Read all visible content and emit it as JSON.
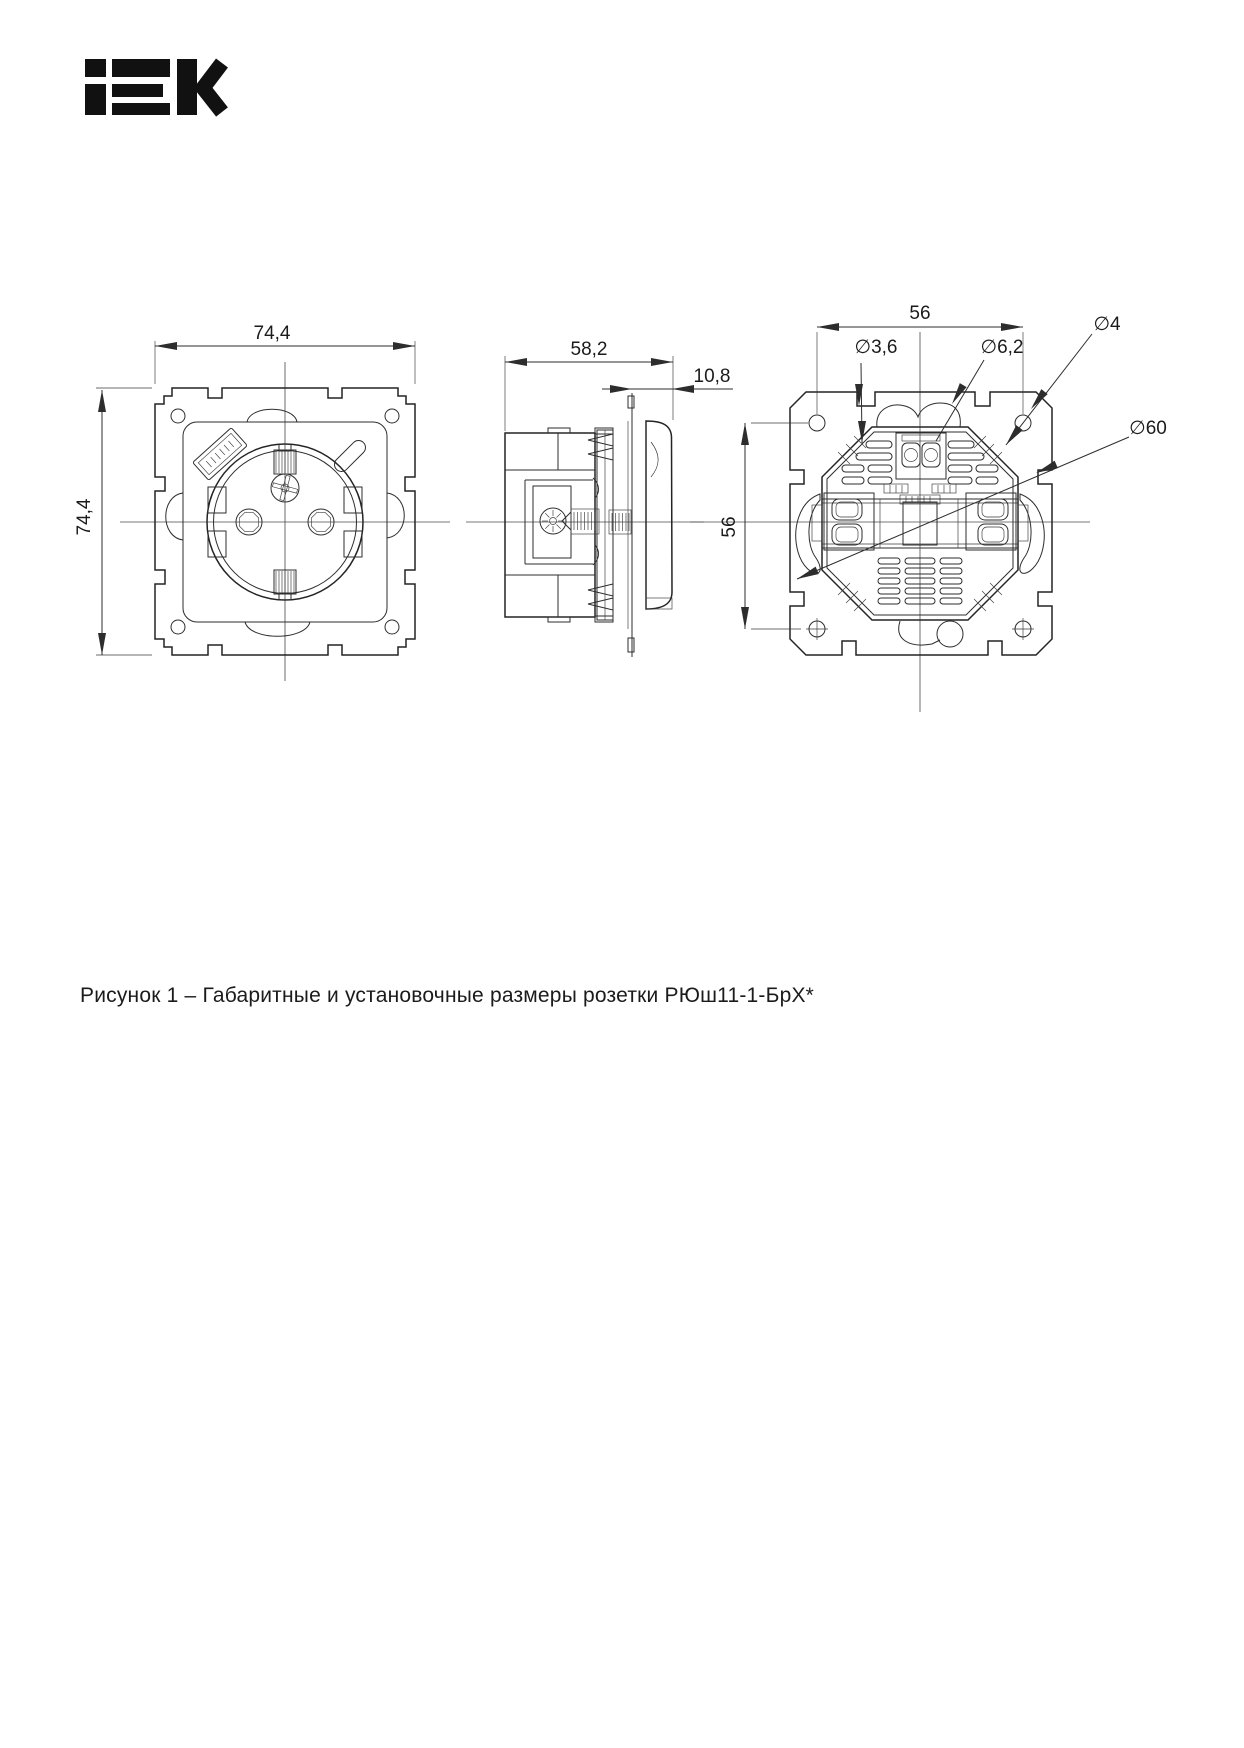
{
  "page": {
    "background": "#ffffff"
  },
  "logo": {
    "text": "IEK",
    "color": "#111111"
  },
  "drawing": {
    "line_color": "#2d2d2d",
    "dimensions": {
      "front_width": "74,4",
      "front_height": "74,4",
      "side_depth": "58,2",
      "frame_thickness": "10,8",
      "mount_spacing_horizontal": "56",
      "mount_spacing_vertical": "56",
      "dia_claw_hole": "∅3,6",
      "dia_terminal_hole": "∅6,2",
      "dia_corner_hole": "∅4",
      "dia_body": "∅60"
    }
  },
  "figure_caption": "Рисунок 1 – Габаритные и установочные размеры розетки РЮш11-1-БрХ*"
}
